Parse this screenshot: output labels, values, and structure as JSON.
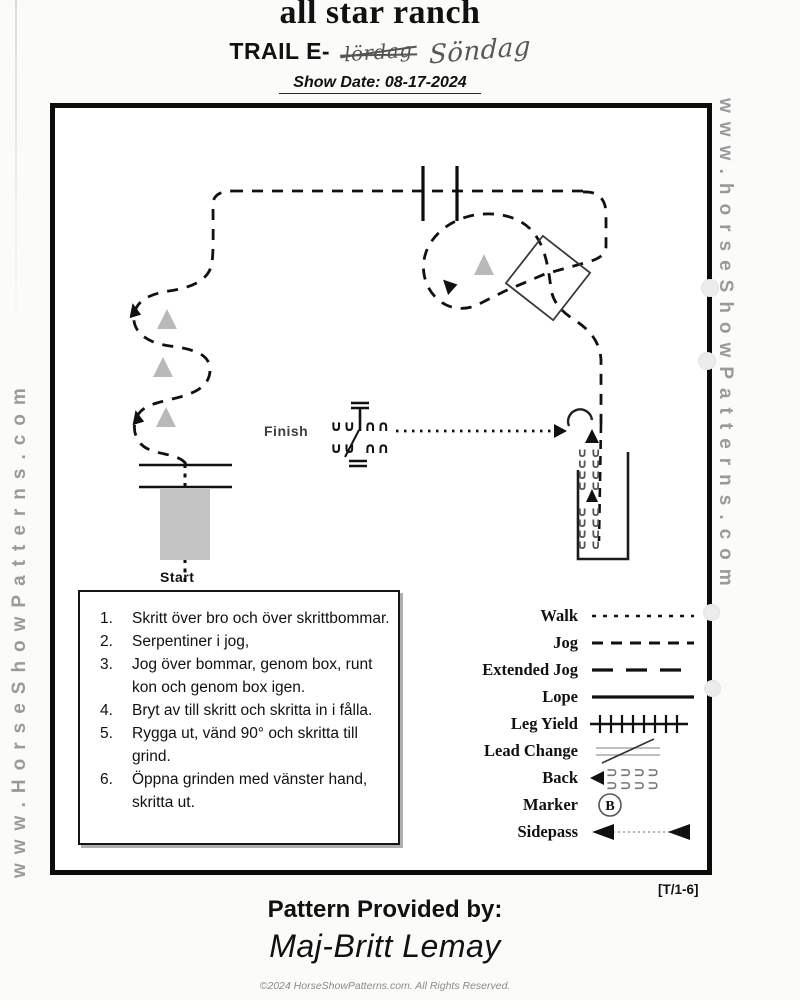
{
  "header": {
    "title": "all star ranch",
    "class_label": "TRAIL E-",
    "crossed_out": "lördag",
    "handwritten": "Söndag",
    "show_date": "Show Date: 08-17-2024"
  },
  "watermarks": {
    "left": "www.HorseShowPatterns.com",
    "right": "www.horseShowPatterns.com"
  },
  "diagram": {
    "start_label": "Start",
    "finish_label": "Finish"
  },
  "instructions": [
    {
      "num": "1.",
      "text": "Skritt över bro och över skrittbommar."
    },
    {
      "num": "2.",
      "text": "Serpentiner i jog,"
    },
    {
      "num": "3.",
      "text": "Jog över bommar, genom box, runt kon och genom box igen."
    },
    {
      "num": "4.",
      "text": "Bryt av till skritt och skritta in i fålla."
    },
    {
      "num": "5.",
      "text": "Rygga ut, vänd 90° och skritta till grind."
    },
    {
      "num": "6.",
      "text": "Öppna grinden med vänster hand, skritta ut."
    }
  ],
  "legend": {
    "items": [
      {
        "label": "Walk",
        "type": "dotted-line"
      },
      {
        "label": "Jog",
        "type": "dashed-line"
      },
      {
        "label": "Extended Jog",
        "type": "long-dashed-line"
      },
      {
        "label": "Lope",
        "type": "solid-line"
      },
      {
        "label": "Leg Yield",
        "type": "ticked-line"
      },
      {
        "label": "Lead Change",
        "type": "slashed-line"
      },
      {
        "label": "Back",
        "type": "back-chevrons-arrow"
      },
      {
        "label": "Marker",
        "type": "circled-letter"
      },
      {
        "label": "Sidepass",
        "type": "double-arrow-line"
      }
    ],
    "marker_letter": "B"
  },
  "footer": {
    "pattern_ref": "[T/1-6]",
    "provided_by": "Pattern Provided by:",
    "provider": "Maj-Britt Lemay",
    "copyright": "©2024 HorseShowPatterns.com. All Rights Reserved."
  },
  "colors": {
    "path": "#111111",
    "cone": "#b9b9b9",
    "bridge": "#c3c3c3",
    "watermark": "#9a9a9a"
  }
}
